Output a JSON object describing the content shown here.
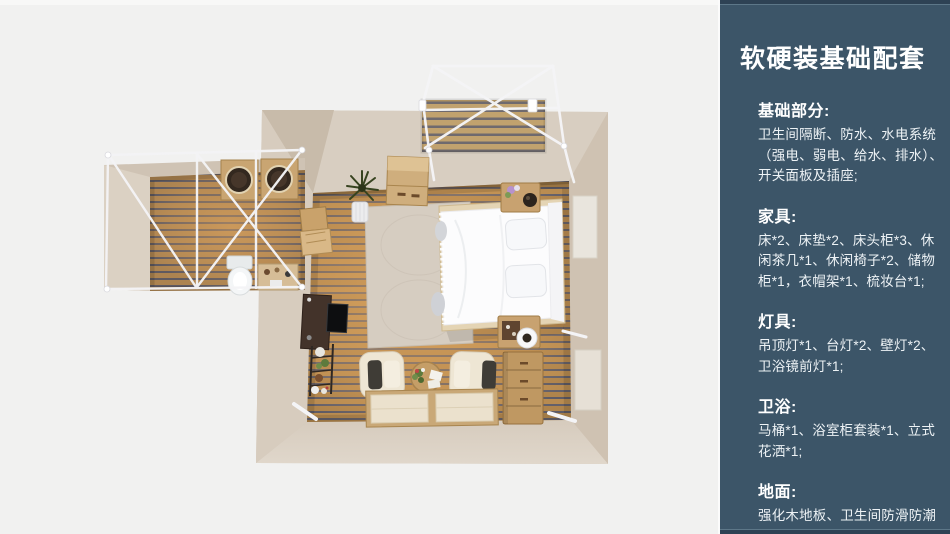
{
  "panel": {
    "title": "软硬装基础配套",
    "sections": [
      {
        "title": "基础部分:",
        "lines": [
          "卫生间隔断、防水、水电系统",
          "（强电、弱电、给水、排水）、",
          "开关面板及插座;"
        ]
      },
      {
        "title": "家具:",
        "lines": [
          "床*2、床垫*2、床头柜*3、休",
          "闲茶几*1、休闲椅子*2、储物",
          "柜*1，衣帽架*1、梳妆台*1;"
        ]
      },
      {
        "title": "灯具:",
        "lines": [
          "吊顶灯*1、台灯*2、壁灯*2、",
          "卫浴镜前灯*1;"
        ]
      },
      {
        "title": "卫浴:",
        "lines": [
          "马桶*1、浴室柜套装*1、立式",
          "花洒*1;"
        ]
      },
      {
        "title": "地面:",
        "lines": [
          "强化木地板、卫生间防滑防潮",
          "石塑板;"
        ]
      }
    ]
  },
  "colors": {
    "panel_bg": "#3c5568",
    "panel_edge": "#2e4254",
    "page_bg": "#f1f1f0",
    "wall_beige": "#d3c8ba",
    "floor_wood": "#b88b50",
    "frame_white": "#f5f5f7"
  }
}
